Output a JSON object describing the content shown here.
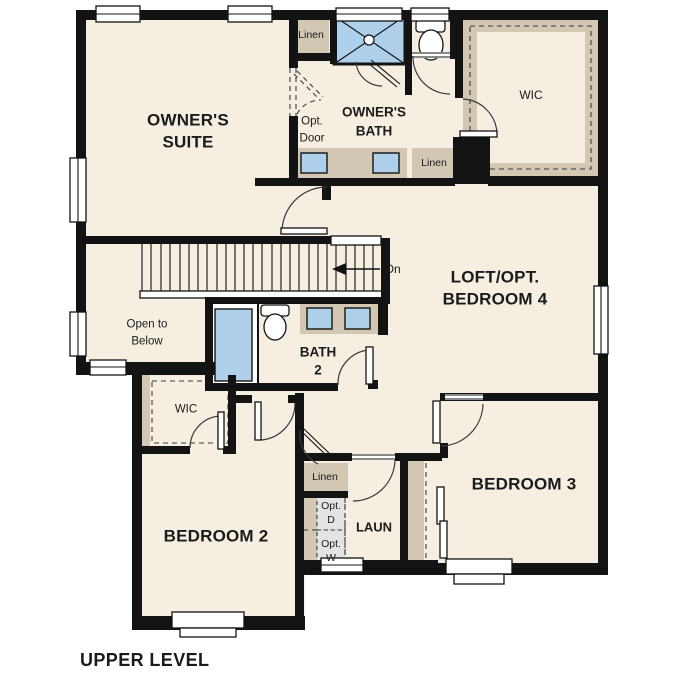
{
  "page_title": "UPPER LEVEL",
  "colors": {
    "floor": "#f5eee1",
    "wall": "#131313",
    "cabinet": "#d2c7b2",
    "fixture": "#aed0ea",
    "appliance": "#e4e4e4",
    "background": "#ffffff",
    "line": "#3a3a3a",
    "text": "#1b1b1b"
  },
  "rooms": {
    "owners_suite": {
      "line1": "OWNER'S",
      "line2": "SUITE"
    },
    "owners_bath": {
      "line1": "OWNER'S",
      "line2": "BATH"
    },
    "wic_owners": {
      "label": "WIC"
    },
    "loft": {
      "line1": "LOFT/OPT.",
      "line2": "BEDROOM 4"
    },
    "open_to_below": {
      "line1": "Open to",
      "line2": "Below"
    },
    "bath2": {
      "line1": "BATH",
      "line2": "2"
    },
    "wic_bedroom2": {
      "label": "WIC"
    },
    "bedroom2": {
      "label": "BEDROOM 2"
    },
    "bedroom3": {
      "label": "BEDROOM 3"
    },
    "laundry": {
      "label": "LAUN"
    }
  },
  "closets": {
    "linen_upper": "Linen",
    "linen_bath": "Linen",
    "linen_hall": "Linen"
  },
  "annotations": {
    "optional_door": {
      "line1": "Opt.",
      "line2": "Door"
    },
    "stairs_direction": "Dn",
    "optional_dryer": {
      "line1": "Opt.",
      "line2": "D"
    },
    "optional_washer": {
      "line1": "Opt.",
      "line2": "W"
    }
  }
}
